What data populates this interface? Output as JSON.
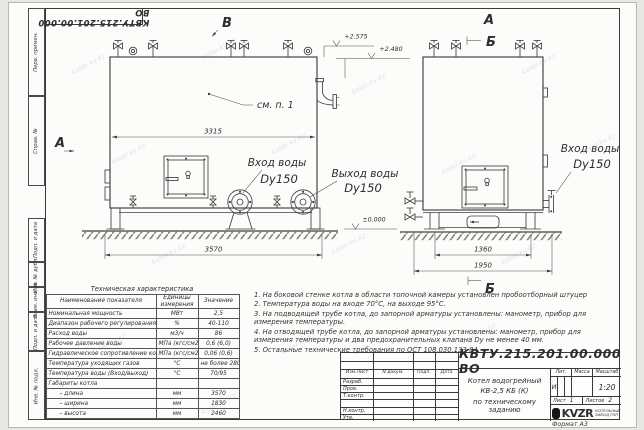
{
  "watermark": {
    "text": "kotel-kv.kz"
  },
  "frame": {
    "doc_number_top": "КВТУ.215.201.00.000 ВО",
    "format_note": "Формат  А3",
    "sidebar": {
      "items": [
        {
          "label": "Перв. примен."
        },
        {
          "label": "Справ. №"
        },
        {
          "label": "Подп. и дата"
        },
        {
          "label": "Инв. № дубл."
        },
        {
          "label": "Взам. инв. №"
        },
        {
          "label": "Подп. и дата"
        },
        {
          "label": "Инв. № подл."
        }
      ]
    }
  },
  "drawing": {
    "views": {
      "front_mark": "В",
      "front_cut": "А",
      "side_top_a": "А",
      "side_top_b": "Б",
      "side_bottom_b": "Б"
    },
    "elevations": {
      "top": "+2.575",
      "nozzle": "+2.480",
      "zero": "±0.000"
    },
    "callout_see_note": "см. п. 1",
    "ports": {
      "front_inlet_line1": "Вход воды",
      "front_inlet_line2": "Dy150",
      "front_outlet_line1": "Выход воды",
      "front_outlet_line2": "Dy150",
      "side_inlet_line1": "Вход воды",
      "side_inlet_line2": "Dy150"
    },
    "dims": {
      "front_inner": "3315",
      "front_overall": "3570",
      "side_inner": "1360",
      "side_overall": "1950"
    }
  },
  "spec_table": {
    "title": "Техническая характеристика",
    "col_name": "Наименование показателя",
    "col_unit": "Единицы измерения",
    "col_value": "Значение",
    "rows": [
      {
        "name": "Номинальная мощность",
        "unit": "МВт",
        "value": "2,5"
      },
      {
        "name": "Диапазон рабочего регулирования",
        "unit": "%",
        "value": "40-110"
      },
      {
        "name": "Расход воды",
        "unit": "м3/ч",
        "value": "86"
      },
      {
        "name": "Рабочее давление воды",
        "unit": "МПа (кгс/см2)",
        "value": "0,6 (6,0)"
      },
      {
        "name": "Гидравлическое сопротивление котла",
        "unit": "МПа (кгс/см2)",
        "value": "0,06 (0,6)"
      },
      {
        "name": "Температура уходящих газов",
        "unit": "°С",
        "value": "не более 280"
      },
      {
        "name": "Температура воды (Вход/выход)",
        "unit": "°С",
        "value": "70/95"
      },
      {
        "name": "Габариты котла",
        "unit": "",
        "value": ""
      },
      {
        "name": "– длина",
        "unit": "мм",
        "value": "3570"
      },
      {
        "name": "– ширина",
        "unit": "мм",
        "value": "1830"
      },
      {
        "name": "– высота",
        "unit": "мм",
        "value": "2460"
      }
    ]
  },
  "notes": {
    "items": [
      "1.  На боковой стенке котла в области топочной камеры установлен пробоотборный штуцер",
      "2.  Температура воды на входе  70°С,  на выходе  95°С.",
      "3.  На подводящей трубе котла, до запорной арматуры установлены:  манометр,  прибор для измерения температуры.",
      "4.  На отводящей трубе котла, до запорной арматуры установлены:  манометр,  прибор для измерения температуры и два предохранительных клапана  Dу не менее  40 мм.",
      "5.  Остальные технические требования по ОСТ  108.030.133-84."
    ]
  },
  "title_block": {
    "doc_number": "КВТУ.215.201.00.000  ВО",
    "product_line1": "Котел водогрейный",
    "product_line2": "КВ-2,5  КБ  (К)",
    "product_line3": "по техническому заданию",
    "rev_cols": {
      "c1": "Изм.Лист",
      "c2": "N докум.",
      "c3": "Подп.",
      "c4": "Дата"
    },
    "roles": {
      "r1": "Разраб.",
      "r2": "Пров.",
      "r3": "Т.контр.",
      "r4": "Н.контр.",
      "r5": "Утв."
    },
    "lit_label": "Лит.",
    "mass_label": "Масса",
    "scale_label": "Масштаб",
    "lit_value": "И",
    "scale_value": "1:20",
    "sheet_label": "Лист",
    "sheet_value": "1",
    "sheets_label": "Листов",
    "sheets_value": "2",
    "brand": "KVZR",
    "brand_line1": "КОТЕЛЬНЫЙ",
    "brand_line2": "ЗАВОД РЭП"
  }
}
